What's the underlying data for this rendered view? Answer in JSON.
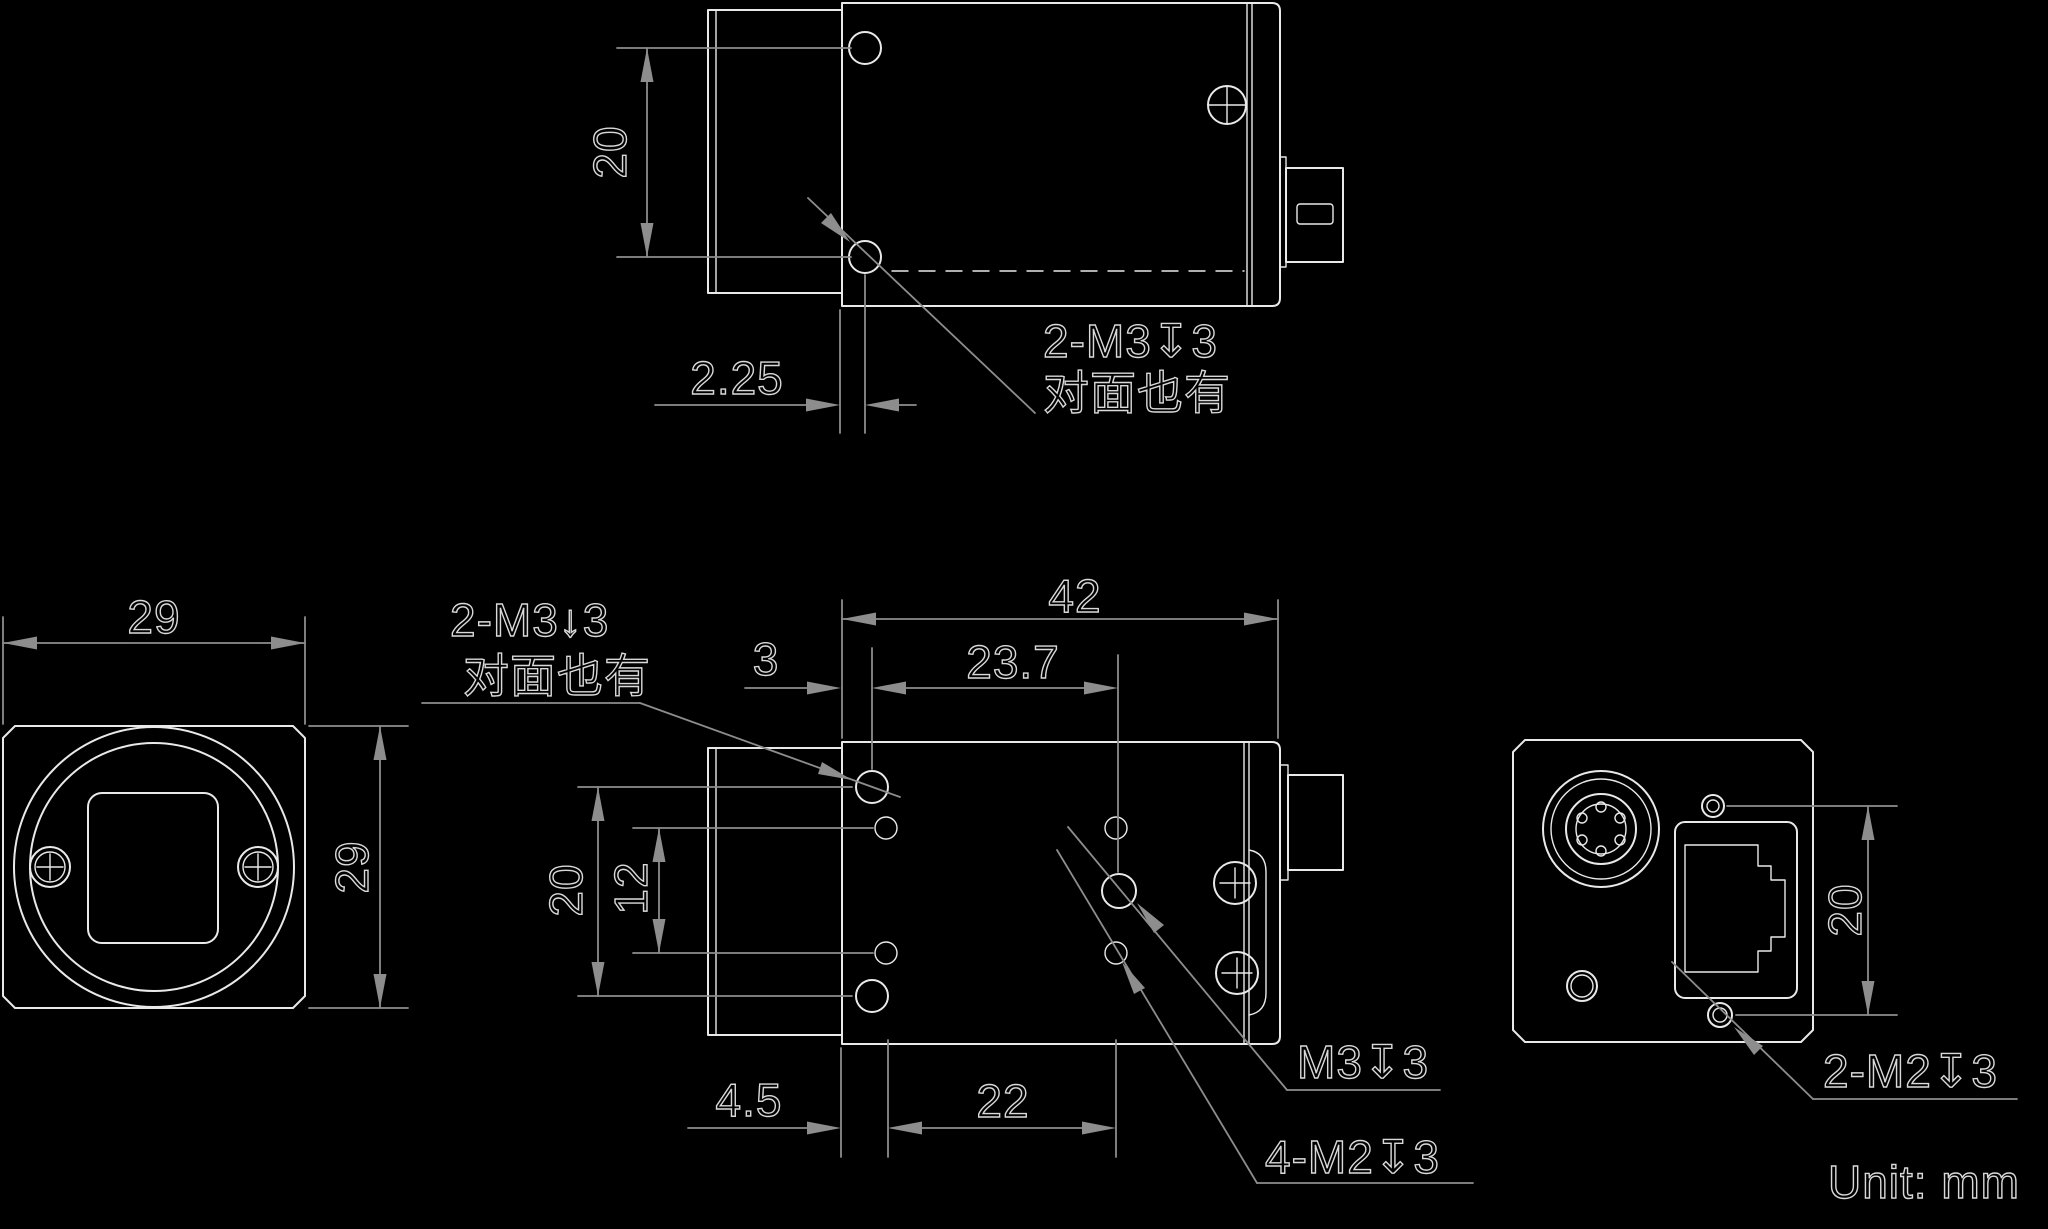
{
  "meta": {
    "drawing_type": "camera dimensional drawing",
    "unit_label": "Unit: mm",
    "colors": {
      "background": "#000000",
      "outline": "#e9e9e9",
      "dimension": "#8d8d8d",
      "text": "#d9d9d9"
    }
  },
  "top_view": {
    "dim_hole_spacing": "20",
    "dim_hole_setback": "2.25",
    "thread_label": "2-M3↧3",
    "thread_note": "对面也有"
  },
  "front_view": {
    "dim_width": "29",
    "dim_height": "29"
  },
  "side_view": {
    "dim_length": "42",
    "dim_m3_setback": "3",
    "dim_m3_center_offset": "23.7",
    "dim_m3_spacing": "20",
    "dim_m2_spacing_vertical": "12",
    "dim_m2_setback": "4.5",
    "dim_m2_pitch": "22",
    "thread_label": "2-M3↓3",
    "thread_note": "对面也有",
    "m3_label": "M3↧3",
    "m2_label": "4-M2↧3"
  },
  "rear_view": {
    "dim_screw_spacing": "20",
    "m2_label": "2-M2↧3"
  }
}
